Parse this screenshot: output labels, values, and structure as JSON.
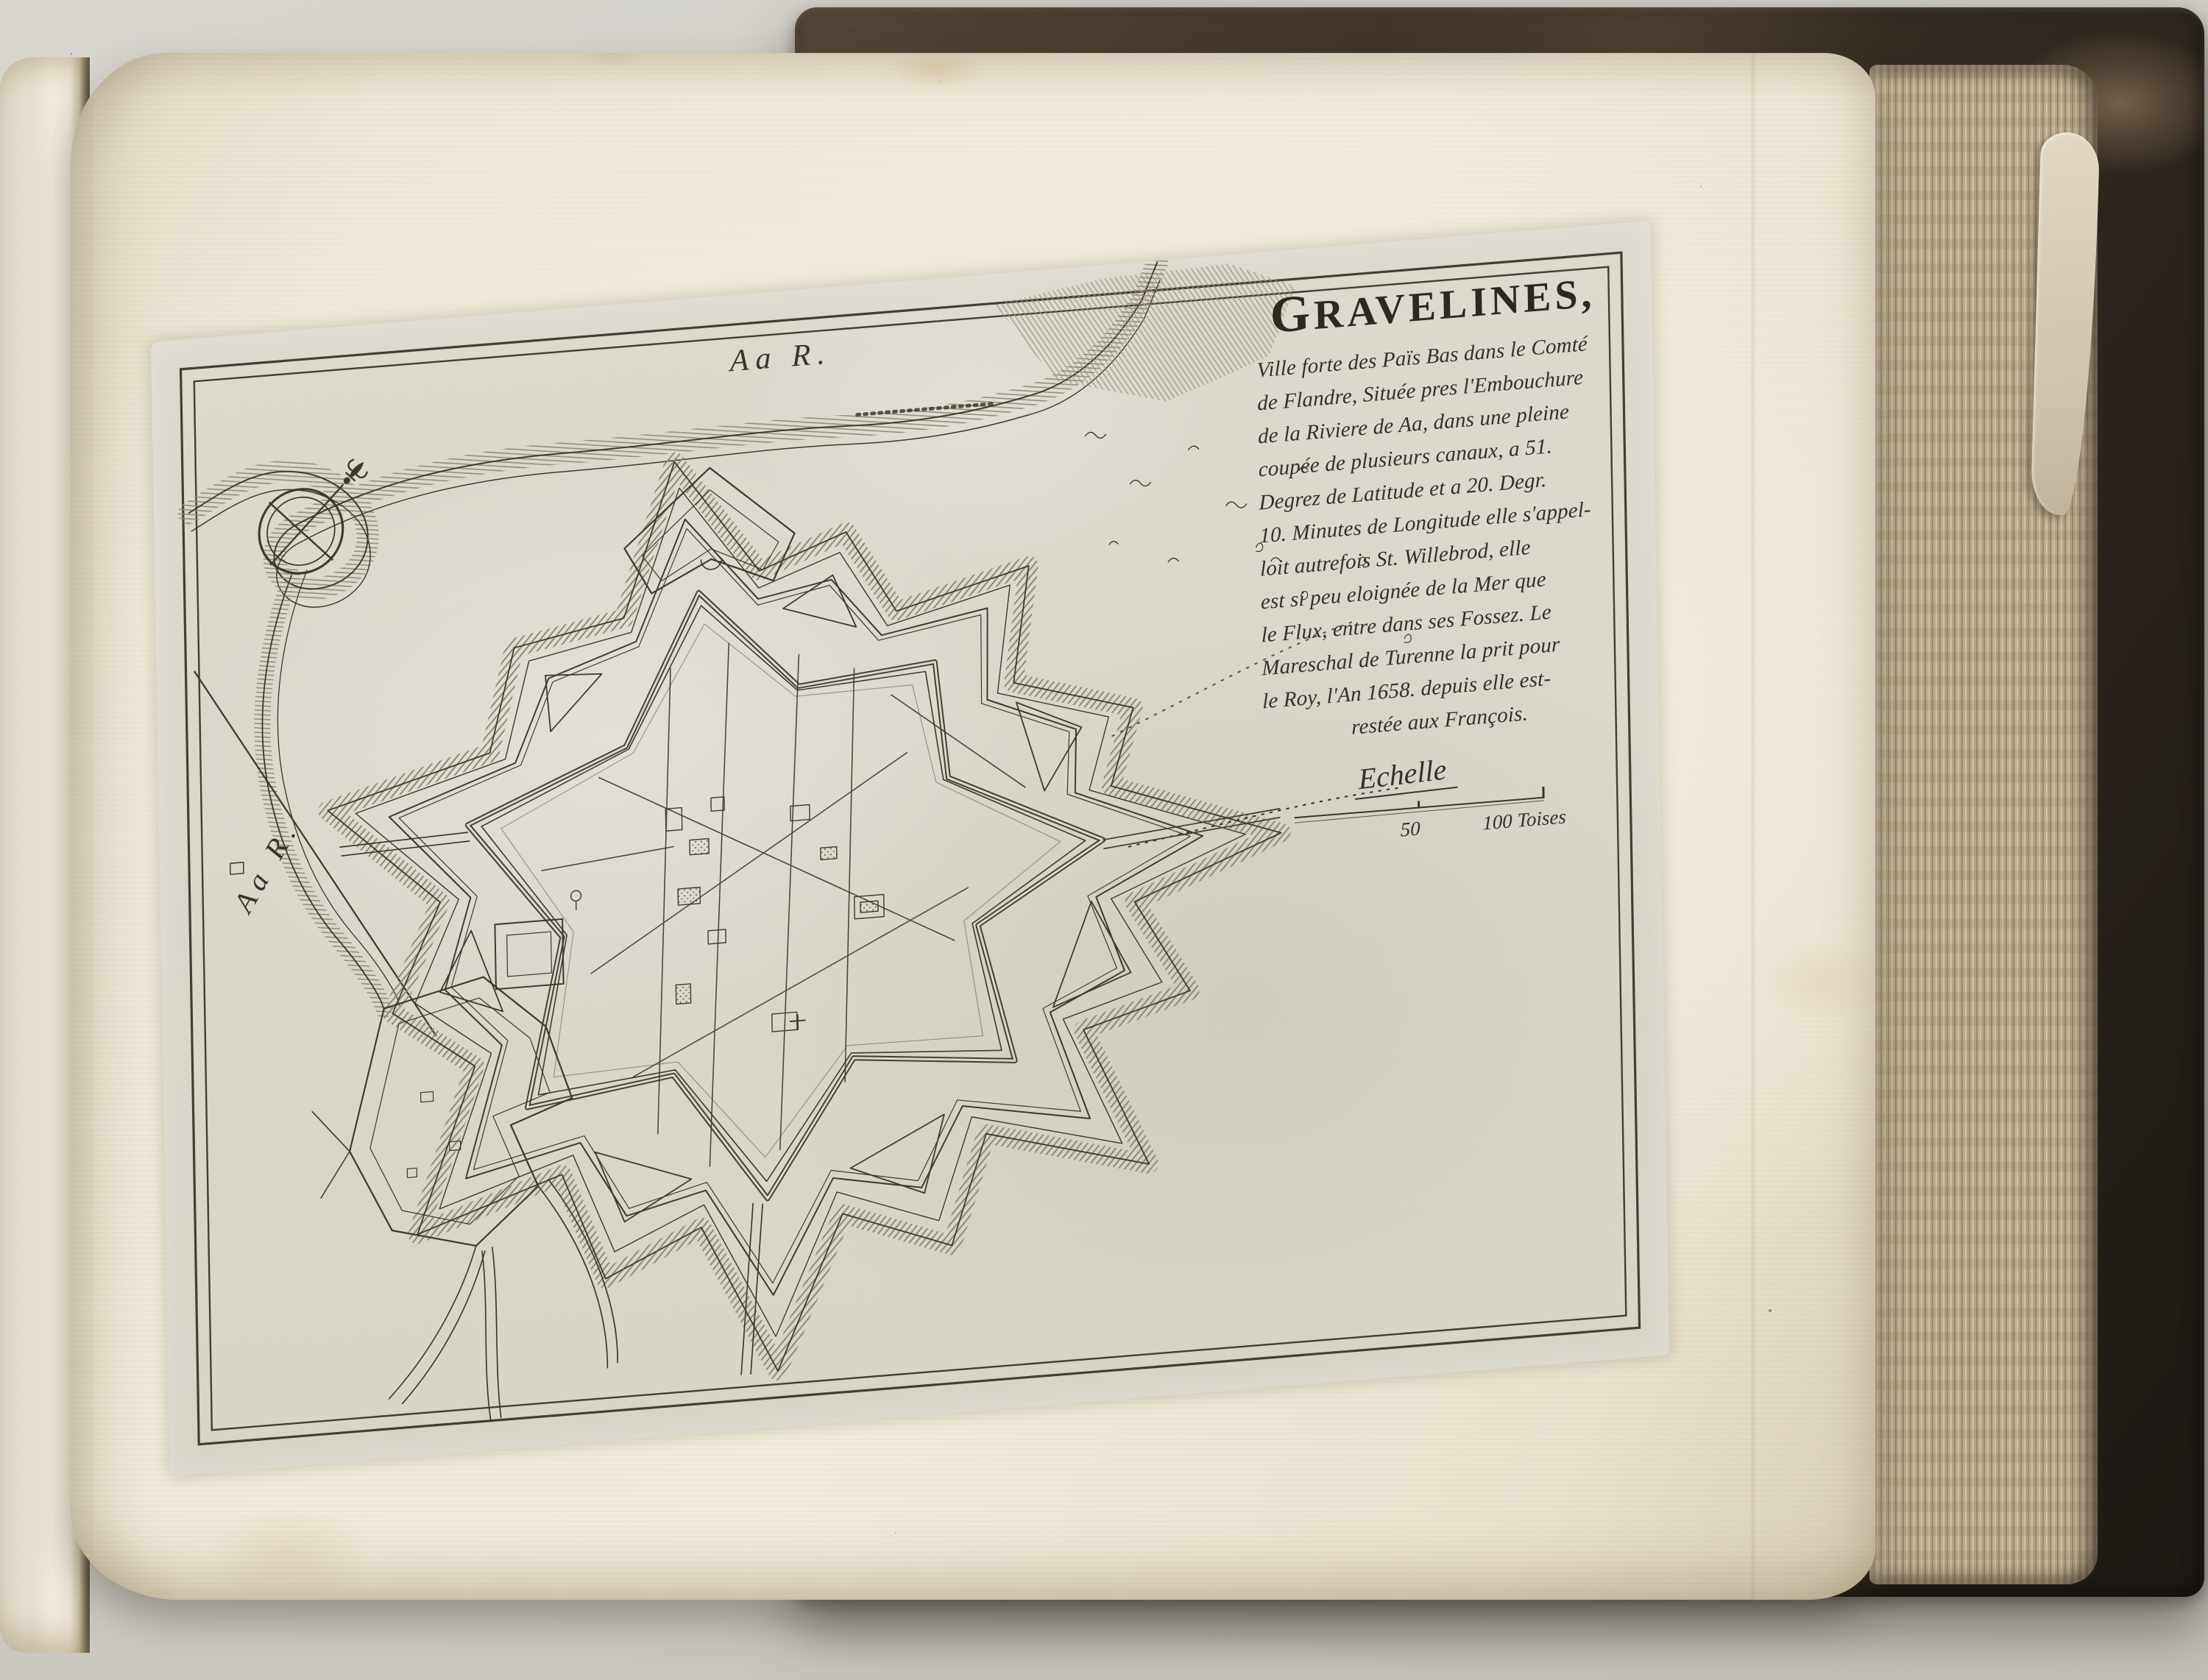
{
  "plate": {
    "title": "GRAVELINES,",
    "description_lines": [
      "Ville forte des Païs Bas dans le Comté",
      "de Flandre, Située pres l'Embouchure",
      "de la Riviere de Aa, dans une pleine",
      "coupée de plusieurs canaux, a 51.",
      "Degrez de Latitude et a 20. Degr.",
      "10. Minutes de Longitude elle s'appel-",
      "loit autrefois St. Willebrod, elle",
      "est si peu eloignée de la Mer que",
      "le Flux, entre dans ses Fossez. Le",
      "Mareschal de Turenne la prit pour",
      "le Roy, l'An 1658. depuis elle est-",
      "restée aux François."
    ],
    "scale": {
      "label": "Echelle",
      "mid_value": "50",
      "end_value": "100 Toises"
    },
    "labels": {
      "river_top": "Aa R.",
      "river_left": "Aa R."
    }
  },
  "colors": {
    "backdrop_gray": "#d2cfc9",
    "page_cream": "#f0ebdb",
    "plate_gray": "#dbd8ce",
    "engraving_ink": "#3a342b",
    "hatch_tone": "#8f8874",
    "cover_brown": "#2b241d",
    "fore_edge_tan": "#b3a584"
  }
}
